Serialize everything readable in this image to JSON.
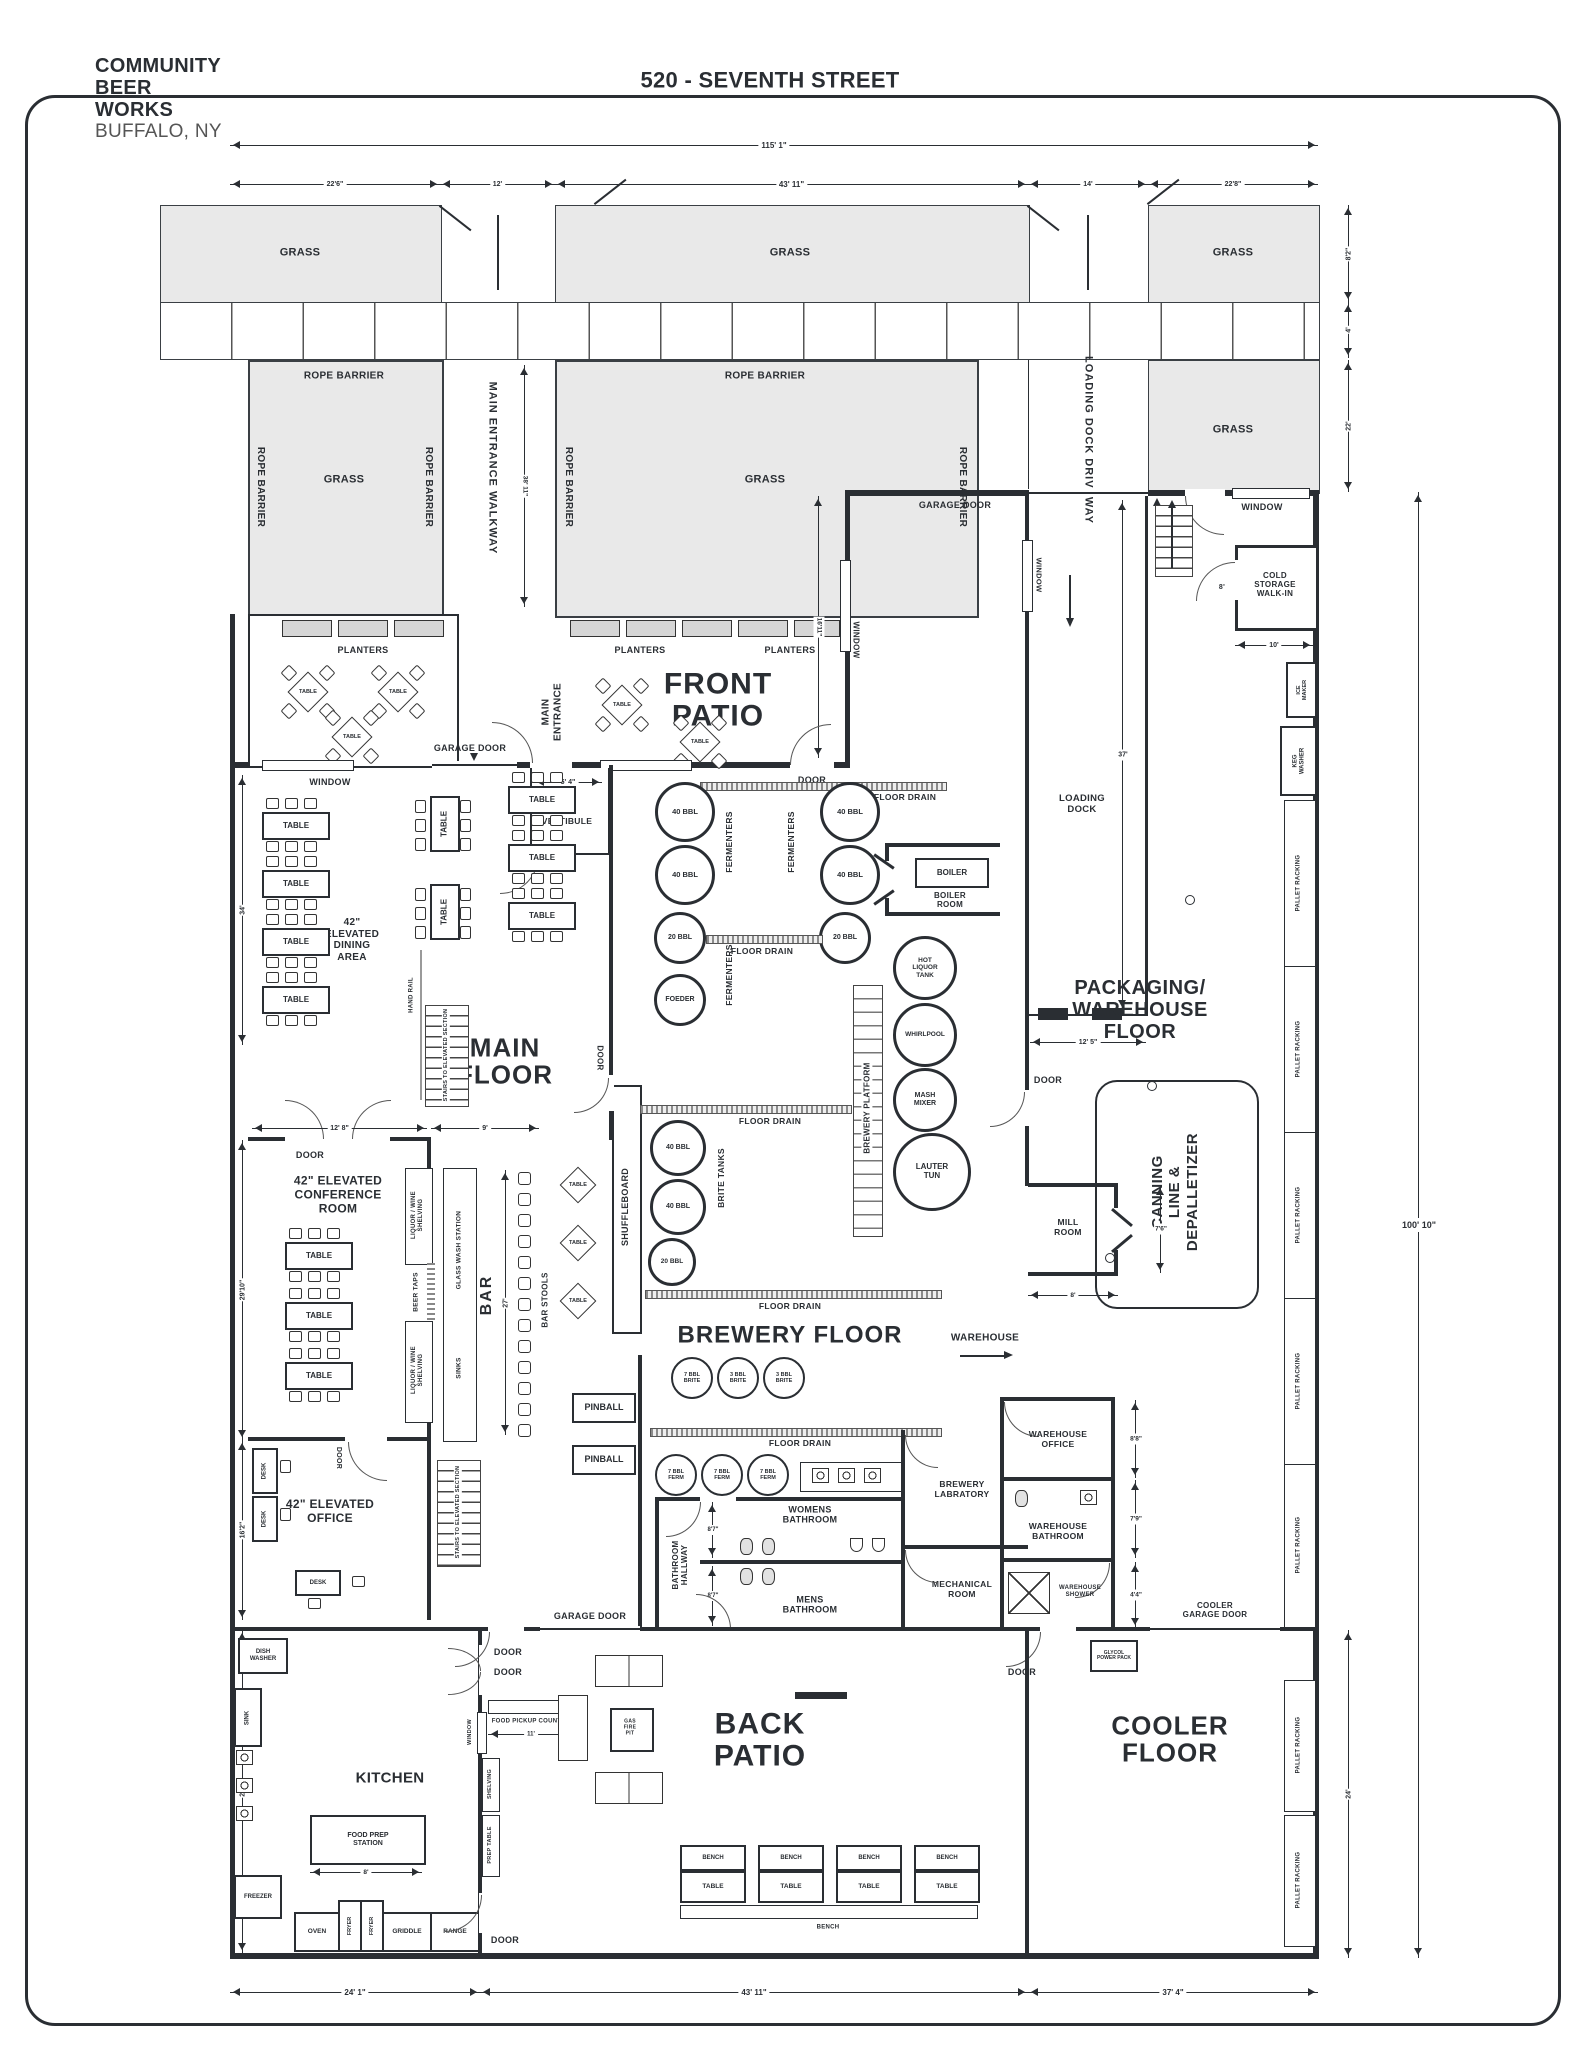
{
  "h": {
    "logo1": "COMMUNITY",
    "logo2": "BEER",
    "logo3": "WORKS",
    "city": "BUFFALO, NY",
    "title": "520 - SEVENTH STREET"
  },
  "s": {
    "grass": "GRASS",
    "rope": "ROPE BARRIER",
    "planters": "PLANTERS",
    "walkway": "MAIN ENTRANCE WALKWAY",
    "driveway": "LOADING DOCK DRIVEWAY",
    "main_entrance": "MAIN\nENTRANCE",
    "vestibule": "VESTIBULE",
    "window": "WINDOW",
    "door": "DOOR",
    "garage_door": "GARAGE DOOR",
    "table": "TABLE",
    "bench": "BENCH",
    "warehouse": "WAREHOUSE"
  },
  "r": {
    "front_patio": "FRONT\nPATIO",
    "back_patio": "BACK\nPATIO",
    "main_floor": "MAIN\nFLOOR",
    "brewery_floor": "BREWERY FLOOR",
    "packaging": "PACKAGING/\nWAREHOUSE\nFLOOR",
    "cooler": "COOLER\nFLOOR",
    "dining": "42\"\nELEVATED\nDINING\nAREA",
    "conference": "42\" ELEVATED\nCONFERENCE\nROOM",
    "office": "42\" ELEVATED\nOFFICE",
    "kitchen": "KITCHEN",
    "loading_dock": "LOADING\nDOCK",
    "boiler_room": "BOILER\nROOM",
    "mill_room": "MILL\nROOM",
    "cold_storage": "COLD\nSTORAGE\nWALK-IN",
    "womens": "WOMENS\nBATHROOM",
    "mens": "MENS\nBATHROOM",
    "hallway": "BATHROOM\nHALLWAY",
    "lab": "BREWERY\nLABRATORY",
    "mech": "MECHANICAL\nROOM",
    "wh_office": "WAREHOUSE\nOFFICE",
    "wh_bath": "WAREHOUSE\nBATHROOM",
    "wh_shower": "WAREHOUSE\nSHOWER",
    "cooler_gd": "COOLER\nGARAGE DOOR",
    "glycol": "GLYCOL\nPOWER PACK",
    "canning": "CANNING\nLINE &\nDEPALLETIZER"
  },
  "e": {
    "f40": "40 BBL",
    "f20": "20 BBL",
    "foeder": "FOEDER",
    "fermenters": "FERMENTERS",
    "brites": "BRITE TANKS",
    "hlt": "HOT\nLIQUOR\nTANK",
    "whirlpool": "WHIRLPOOL",
    "mash": "MASH\nMIXER",
    "lauter": "LAUTER\nTUN",
    "platform": "BREWERY PLATFORM",
    "boiler": "BOILER",
    "brite7": "7 BBL\nBRITE",
    "brite3": "3 BBL\nBRITE",
    "ferm7": "7 BBL\nFERM",
    "floor_drain": "FLOOR DRAIN",
    "bar": "BAR",
    "bar_stools": "BAR STOOLS",
    "beer_taps": "BEER TAPS",
    "liquor": "LIQUOR / WINE\nSHELVING",
    "glass_wash": "GLASS WASH STATION",
    "sinks": "SINKS",
    "shuffleboard": "SHUFFLEBOARD",
    "pinball": "PINBALL",
    "hand_rail": "HAND RAIL",
    "stairs": "STAIRS TO ELEVATED SECTION",
    "ice_maker": "ICE MAKER",
    "keg_washer": "KEG WASHER",
    "pallet": "PALLET RACKING",
    "desk": "DESK",
    "dish_washer": "DISH\nWASHER",
    "sink": "SINK",
    "freezer": "FREEZER",
    "oven": "OVEN",
    "fryer": "FRYER",
    "griddle": "GRIDDLE",
    "range": "RANGE",
    "food_prep": "FOOD PREP\nSTATION",
    "pickup": "FOOD PICKUP COUNTER",
    "prep_table": "PREP TABLE",
    "shelving": "SHELVING",
    "fire_pit": "GAS\nFIRE\nPIT"
  },
  "d": {
    "t115": "115' 1\"",
    "a22_6": "22'6\"",
    "a12": "12'",
    "a43_11": "43' 11\"",
    "a14": "14'",
    "a22_8": "22'8\"",
    "r8_2": "8'2\"",
    "r4": "4'",
    "r22": "22'",
    "w38_11": "38' 11\"",
    "e16_11": "16'11\"",
    "v5_4": "5' 4\"",
    "l34": "34'",
    "c12_8": "12' 8\"",
    "c9": "9'",
    "b27": "27'",
    "l29_10": "29'10\"",
    "l16_2": "16'2\"",
    "l28": "28'",
    "ld37": "37'",
    "ld12_5": "12' 5\"",
    "cs10": "10'",
    "cs8": "8'",
    "mill7_6": "7'6\"",
    "mill8": "8'",
    "wo8_8": "8'8\"",
    "wb7_9": "7'9\"",
    "ws4_4": "4'4\"",
    "bh8_7": "8'7\"",
    "k8": "8'",
    "k11": "11'",
    "big100": "100' 10\"",
    "cool24": "24'",
    "s24_1": "24' 1\"",
    "s37_4": "37' 4\""
  }
}
